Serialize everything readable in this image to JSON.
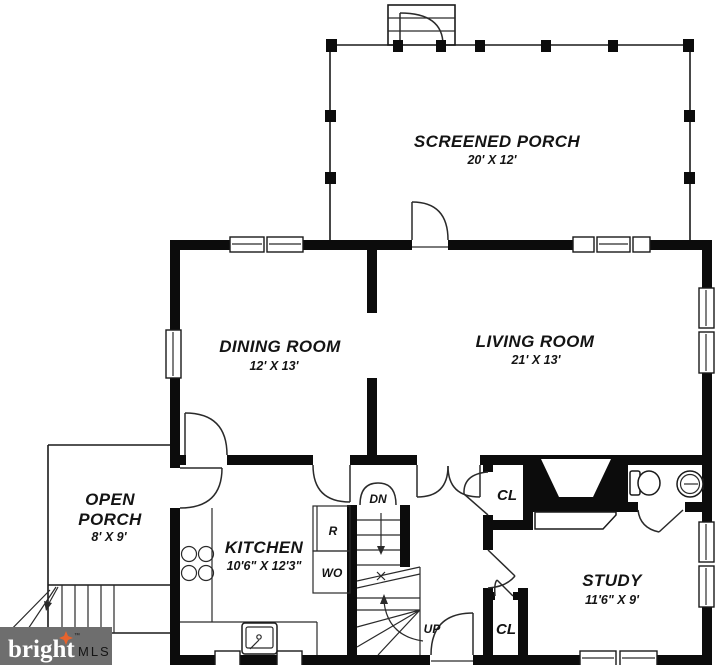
{
  "plan": {
    "rooms": {
      "screened_porch": {
        "name": "SCREENED PORCH",
        "dims": "20' X 12'"
      },
      "dining": {
        "name": "DINING ROOM",
        "dims": "12' X 13'"
      },
      "living": {
        "name": "LIVING ROOM",
        "dims": "21' X 13'"
      },
      "open_porch": {
        "line1": "OPEN",
        "line2": "PORCH",
        "dims": "8' X 9'"
      },
      "kitchen": {
        "name": "KITCHEN",
        "dims": "10'6\" X 12'3\""
      },
      "study": {
        "name": "STUDY",
        "dims": "11'6\" X 9'"
      }
    },
    "labels": {
      "closet_upper": "CL",
      "closet_lower": "CL",
      "refrigerator": "R",
      "wall_oven": "WO",
      "stairs_down": "DN",
      "stairs_up": "UP"
    }
  },
  "watermark": {
    "brand": "bright",
    "trademark": "™",
    "mls": "MLS"
  },
  "colors": {
    "wall": "#0c0c0c",
    "background": "#ffffff",
    "logo_bg": "#6e6e6e",
    "logo_text": "#ffffff",
    "logo_star": "#e8632c",
    "logo_mls": "#d9d9d9"
  }
}
